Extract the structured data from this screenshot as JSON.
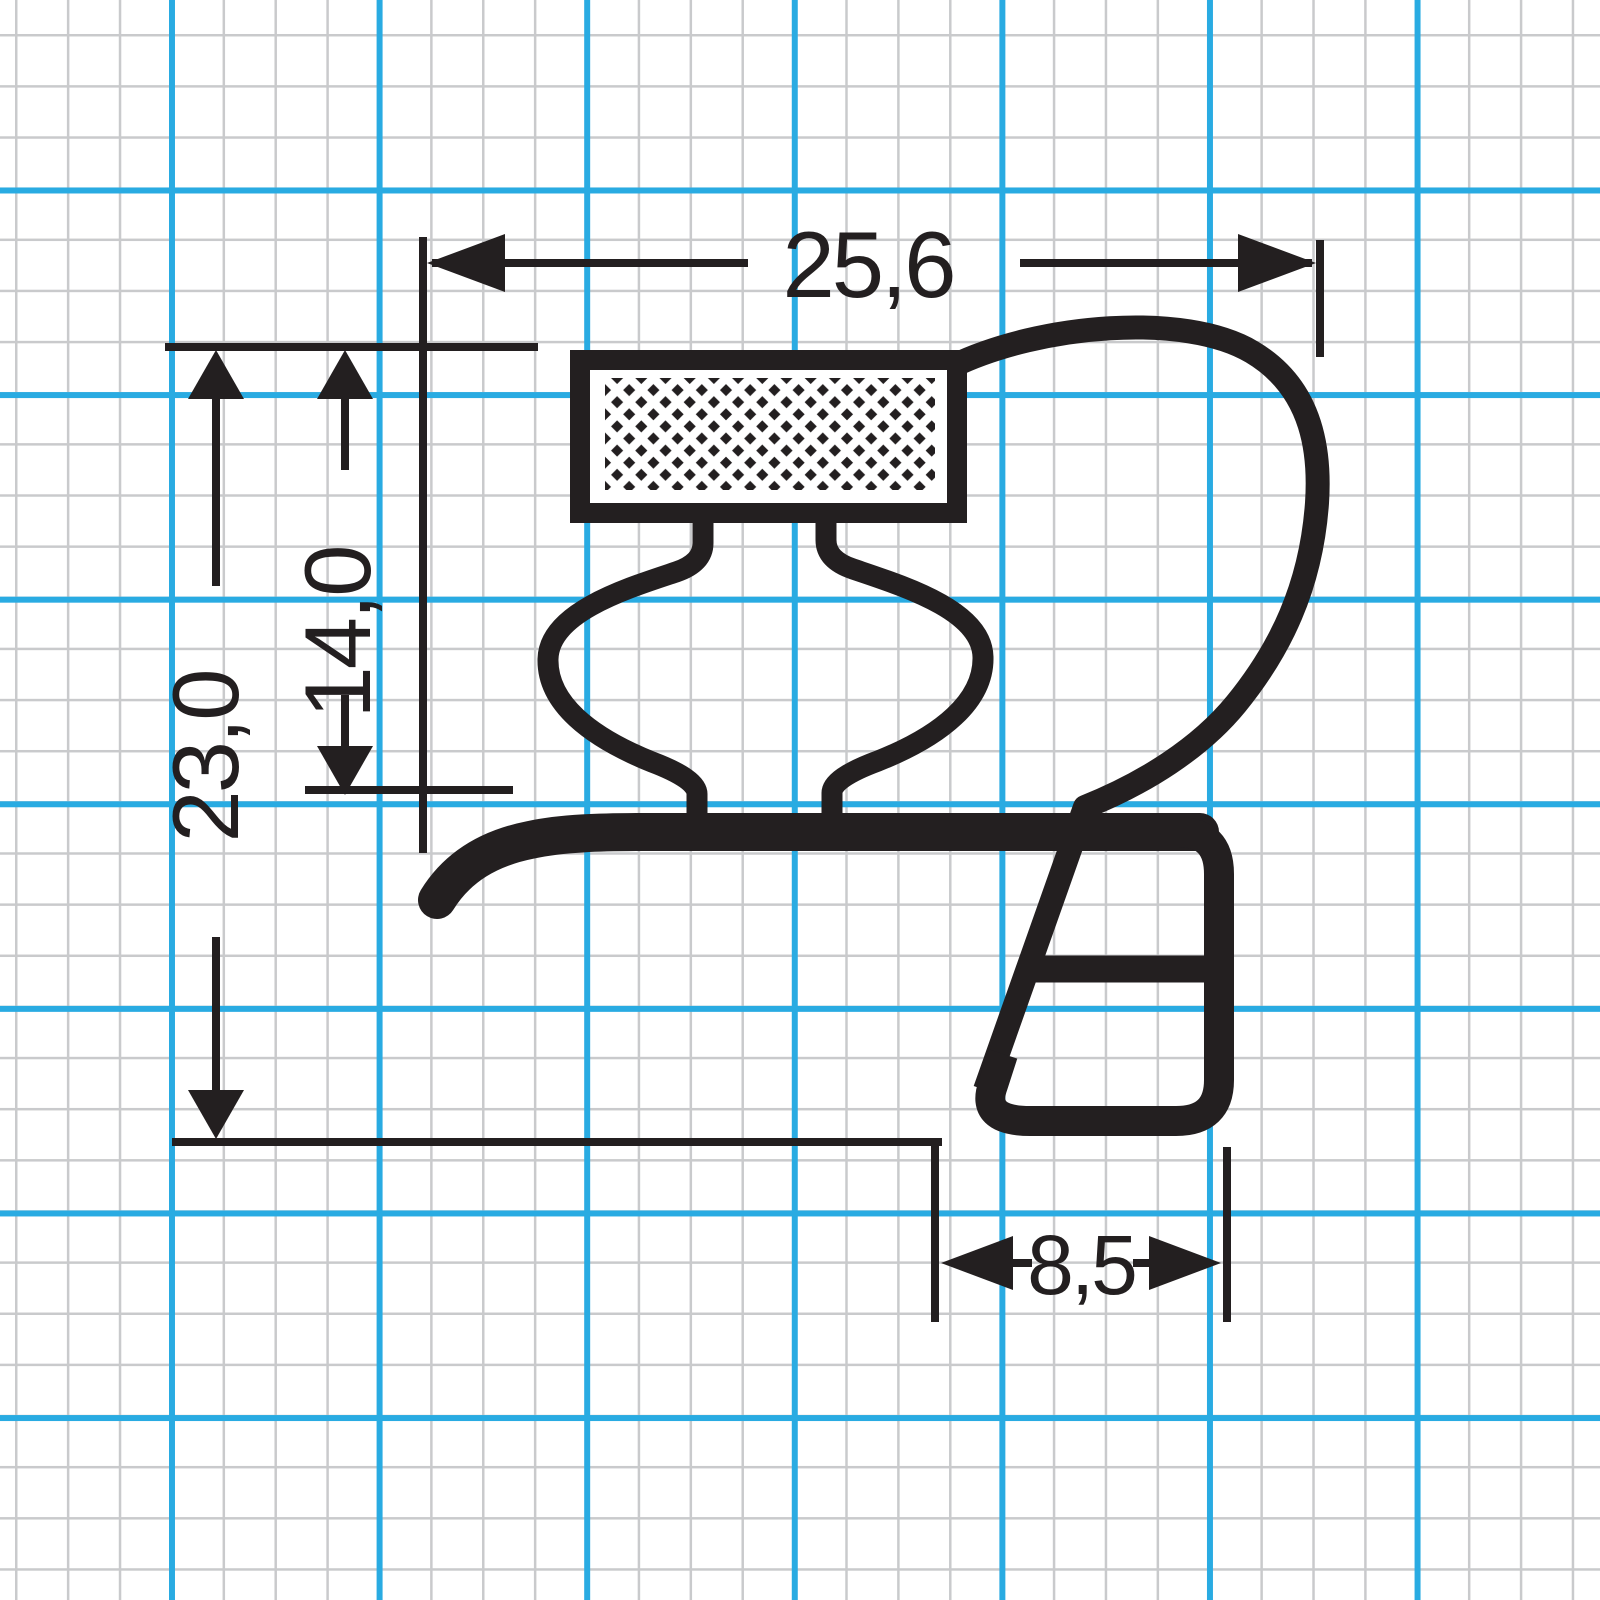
{
  "drawing": {
    "type": "technical-profile-cross-section",
    "subject": "refrigerator-door-gasket-profile-on-graph-paper",
    "dimensions": {
      "top_width": "25,6",
      "upper_height": "14,0",
      "total_height": "23,0",
      "foot_width": "8,5"
    },
    "colors": {
      "line": "#231f20",
      "grid_minor": "#c9cacc",
      "grid_major": "#29abe2",
      "background": "#ffffff"
    }
  }
}
